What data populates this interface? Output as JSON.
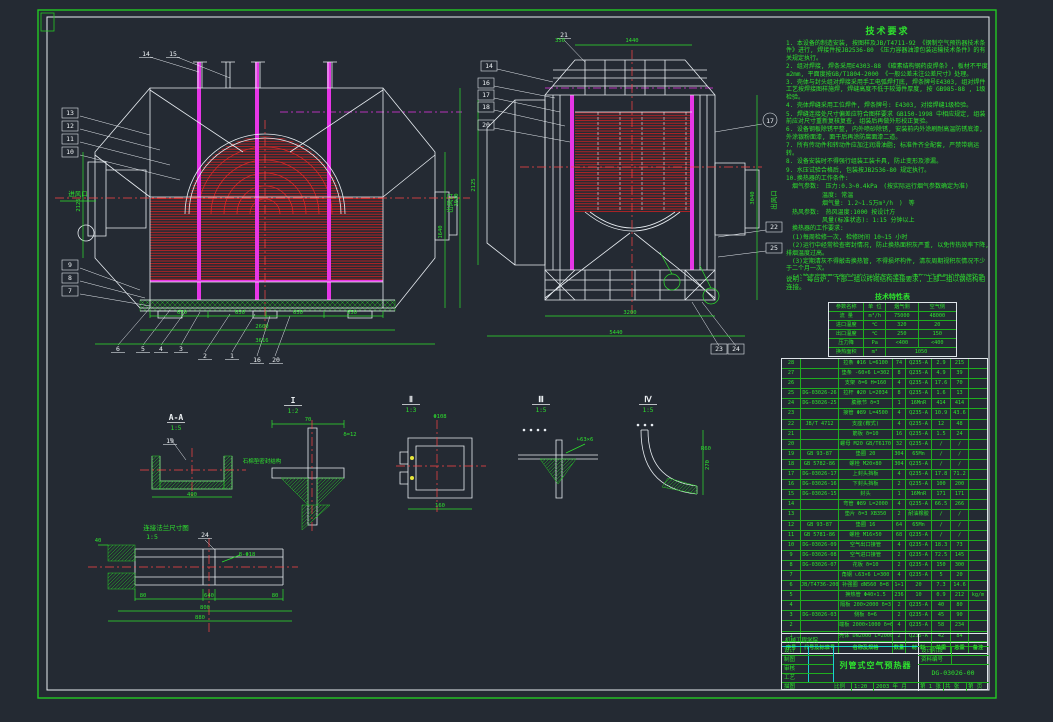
{
  "colors": {
    "green": "#2ee22e",
    "white": "#eef2f5",
    "red": "#d42a2a",
    "centerline_red": "#ff4545",
    "magenta": "#e636e6",
    "cyan": "#19d2d2",
    "yellow": "#e8e83a",
    "background": "#242a33"
  },
  "tech_requirements": {
    "title": "技术要求",
    "items": [
      "1. 本设备的制造安装, 按图样及JB/T4711-92 《钢制空气预热器技术条件》进行, 焊接件按JB2536-80 《压力容器油漆包装运输技术条件》的有关规定执行。",
      "2. 组对焊接, 焊条采用E4303-88 《碳素结构钢药皮焊条》, 板材不平度≤2mm, 平面度按GB/T1804-2000 《一般公差未注公差尺寸》处理。",
      "3. 壳体与封头组对焊接采用手工电弧焊打底, 焊条牌号E4303, 组对焊件工艺按焊接图样施焊, 焊缝高度不低于较薄件厚度, 按 GB985-88 , 1级检验。",
      "4. 壳体焊缝采用工位焊件, 焊条牌号: E4303, 对接焊缝1级检验。",
      "5. 焊缝连接处尺寸偏差应符合图样要求 GB150-1998 中相应规定, 组装前应对尺寸重新复核复查, 组装后再做外形校正复验。",
      "6. 设备钢板除锈平整, 内外喷砂除锈, 安装前内外涂刷耐高温防锈底漆, 外涂银粉面漆, 面干后再涂防腐面漆二道。",
      "7. 所有传动件和转动件应加注润滑油脂; 标准件齐全配套, 严禁带病运转。",
      "8. 设备安装时不得强行组装工装卡具, 防止变形及渗漏。",
      "9. 水压试验合格后, 包装按JB2536-80 规定执行。",
      "10.换热器的工作条件:",
      "　烟气参数:　压力:0.3~0.4kPa　(按实际运行烟气参数确定为准)",
      "　　　　　　温度: 常温",
      "　　　　　　烟气量: 1.2~1.5万m³/h　)　等",
      "　热风参数:　热风温度:1000 按设计方",
      "　　　　　　风量(标准状态): 1:15 分钟以上",
      "　换热器的工作要求:",
      "　(1)每周检修一次, 检修时间 10~15 小时",
      "　(2)运行中经常检查密封情况, 防止换热面积灰严重, 以免传热效率下降, 排烟温度过高。",
      "　(3)定期清灰不得敲击换热管, 不得损坏构件, 清灰周期视积灰情况不少于二个月一次。",
      "　(4)管束定期用压缩空气吹扫以防积灰堵塞, 清灰时注意保护换热管防腐层不受损伤。"
    ]
  },
  "note": "说明: 每台炉, 下部二组以砖砌结构连接要求, 上部二组以钢结构相连接。",
  "char_table": {
    "title": "技术特性表",
    "col_headers": [
      "参数名称",
      "单 位",
      "烟气侧",
      "空气侧"
    ],
    "rows": [
      [
        "流  量",
        "m³/h",
        "75000",
        "48000"
      ],
      [
        "进口温度",
        "℃",
        "320",
        "20"
      ],
      [
        "出口温度",
        "℃",
        "250",
        "150"
      ],
      [
        "压力降",
        "Pa",
        "<400",
        "<400"
      ]
    ],
    "footer": {
      "label": "换热面积",
      "unit": "m²",
      "value": "1050"
    }
  },
  "bom": {
    "headers": [
      "序号",
      "代号及标准号",
      "名称及规格",
      "数量",
      "材 料",
      "单重",
      "总重",
      "备注"
    ],
    "rows": [
      [
        "28",
        "",
        "拉条 Φ16 L=6100",
        "74",
        "Q235-A",
        "2.9",
        "215",
        ""
      ],
      [
        "27",
        "",
        "垫条 -60×6 L=302",
        "8",
        "Q235-A",
        "4.9",
        "39",
        ""
      ],
      [
        "26",
        "",
        "支架 δ=6 H=160",
        "4",
        "Q235-A",
        "17.6",
        "70",
        ""
      ],
      [
        "25",
        "DG-03026-26",
        "拉杆 Φ20 L=2034",
        "8",
        "Q235-A",
        "1.6",
        "13",
        ""
      ],
      [
        "24",
        "DG-03026-25",
        "膨胀节 δ=3",
        "1",
        "16MnR",
        "414",
        "414",
        ""
      ],
      [
        "23",
        "",
        "接管 Φ89 L=4500",
        "4",
        "Q235-A",
        "10.9",
        "43.6",
        ""
      ],
      [
        "22",
        "JB/T 4712",
        "支座(鞍式)",
        "4",
        "Q235-A",
        "12",
        "48",
        ""
      ],
      [
        "21",
        "",
        "筋板 δ=10",
        "16",
        "Q235-A",
        "1.5",
        "24",
        ""
      ],
      [
        "20",
        "",
        "螺母 M20 GB/T6170",
        "32",
        "Q235-A",
        "∕",
        "∕",
        ""
      ],
      [
        "19",
        "GB 93-87",
        "垫圈 20",
        "304",
        "65Mn",
        "∕",
        "∕",
        ""
      ],
      [
        "18",
        "GB 5782-86",
        "螺栓 M20×80",
        "304",
        "Q235-A",
        "∕",
        "∕",
        ""
      ],
      [
        "17",
        "DG-03026-17",
        "上封头挡板",
        "4",
        "Q235-A",
        "17.8",
        "71.2",
        ""
      ],
      [
        "16",
        "DG-03026-16",
        "下封头挡板",
        "2",
        "Q235-A",
        "100",
        "200",
        ""
      ],
      [
        "15",
        "DG-03026-15",
        "封头",
        "1",
        "16MnR",
        "171",
        "171",
        ""
      ],
      [
        "14",
        "",
        "弯管 Φ89 L=2000",
        "4",
        "Q235-A",
        "66.5",
        "266",
        ""
      ],
      [
        "13",
        "",
        "垫片 δ=3 XB350",
        "2",
        "耐油橡胶",
        "∕",
        "∕",
        ""
      ],
      [
        "12",
        "GB 93-87",
        "垫圈 16",
        "64",
        "65Mn",
        "∕",
        "∕",
        ""
      ],
      [
        "11",
        "GB 5781-86",
        "螺栓 M16×50",
        "68",
        "Q235-A",
        "∕",
        "∕",
        ""
      ],
      [
        "10",
        "DG-03026-09",
        "空气出口接管",
        "4",
        "Q235-A",
        "18.3",
        "73",
        ""
      ],
      [
        "9",
        "DG-03026-08",
        "空气进口接管",
        "2",
        "Q235-A",
        "72.5",
        "145",
        ""
      ],
      [
        "8",
        "DG-03026-07",
        "花板 δ=10",
        "2",
        "Q235-A",
        "150",
        "300",
        ""
      ],
      [
        "7",
        "",
        "角钢 ∟63×6 L=300",
        "4",
        "Q235-A",
        "5",
        "20",
        ""
      ],
      [
        "6",
        "JB/T4736-2002",
        "补强圈 dN560 δ=8",
        "1+1",
        "20",
        "7.3",
        "14.6",
        ""
      ],
      [
        "5",
        "",
        "换热管 Φ40×1.5",
        "236",
        "10",
        "0.9",
        "212",
        "kg/m"
      ],
      [
        "4",
        "",
        "隔板 200×2000 δ=3",
        "2",
        "Q235-A",
        "40",
        "80",
        ""
      ],
      [
        "3",
        "DG-03026-03",
        "侧板 δ=6",
        "2",
        "Q235-A",
        "45",
        "90",
        ""
      ],
      [
        "2",
        "",
        "端板 2000×1000 δ=6",
        "4",
        "Q235-A",
        "58",
        "234",
        ""
      ],
      [
        "1",
        "",
        "壳体 DN2000 L=2000",
        "2",
        "Q235-A",
        "42",
        "84",
        ""
      ]
    ]
  },
  "title_block": {
    "company": "机械工程学院",
    "roles": [
      "设计",
      "制图",
      "审核",
      "工艺"
    ],
    "title": "列管式空气预热器",
    "stage_label": "设计阶段",
    "doc_label": "资料编号",
    "drawing_no": "DG-03026-00",
    "bottom": {
      "left_label": "描图",
      "scale_label": "比例",
      "scale": "1:20",
      "date": "2003 年 月",
      "sheet1": "第 1 张",
      "sheet2": "共 张",
      "sheet3": "第 页"
    }
  },
  "annotations": {
    "balloons": [
      {
        "n": "14",
        "x": 146,
        "y": 55,
        "s": "p"
      },
      {
        "n": "15",
        "x": 173,
        "y": 55,
        "s": "p"
      },
      {
        "n": "13",
        "x": 70,
        "y": 114,
        "s": "b"
      },
      {
        "n": "12",
        "x": 70,
        "y": 127,
        "s": "b"
      },
      {
        "n": "11",
        "x": 70,
        "y": 140,
        "s": "b"
      },
      {
        "n": "10",
        "x": 70,
        "y": 153,
        "s": "b"
      },
      {
        "n": "9",
        "x": 70,
        "y": 266,
        "s": "b"
      },
      {
        "n": "8",
        "x": 70,
        "y": 279,
        "s": "b"
      },
      {
        "n": "7",
        "x": 70,
        "y": 292,
        "s": "b"
      },
      {
        "n": "6",
        "x": 118,
        "y": 350,
        "s": "p"
      },
      {
        "n": "5",
        "x": 143,
        "y": 350,
        "s": "p"
      },
      {
        "n": "4",
        "x": 161,
        "y": 350,
        "s": "p"
      },
      {
        "n": "3",
        "x": 181,
        "y": 350,
        "s": "p"
      },
      {
        "n": "2",
        "x": 205,
        "y": 357,
        "s": "p"
      },
      {
        "n": "1",
        "x": 232,
        "y": 357,
        "s": "p"
      },
      {
        "n": "16",
        "x": 257,
        "y": 361,
        "s": "p"
      },
      {
        "n": "20",
        "x": 276,
        "y": 361,
        "s": "p"
      },
      {
        "n": "19",
        "x": 170,
        "y": 442,
        "s": "p"
      },
      {
        "n": "24",
        "x": 205,
        "y": 536,
        "s": "p"
      },
      {
        "n": "21",
        "x": 564,
        "y": 36,
        "s": "p"
      },
      {
        "n": "14",
        "x": 489,
        "y": 67,
        "s": "b"
      },
      {
        "n": "16",
        "x": 486,
        "y": 84,
        "s": "b"
      },
      {
        "n": "17",
        "x": 486,
        "y": 96,
        "s": "b"
      },
      {
        "n": "18",
        "x": 486,
        "y": 108,
        "s": "b"
      },
      {
        "n": "20",
        "x": 486,
        "y": 126,
        "s": "b"
      },
      {
        "n": "17",
        "x": 770,
        "y": 122,
        "s": "c"
      },
      {
        "n": "22",
        "x": 774,
        "y": 228,
        "s": "b"
      },
      {
        "n": "25",
        "x": 774,
        "y": 249,
        "s": "b"
      },
      {
        "n": "23",
        "x": 719,
        "y": 350,
        "s": "b"
      },
      {
        "n": "24",
        "x": 736,
        "y": 350,
        "s": "b"
      }
    ],
    "dims": [
      {
        "t": "650",
        "x": 182,
        "y": 314
      },
      {
        "t": "650",
        "x": 240,
        "y": 314
      },
      {
        "t": "650",
        "x": 298,
        "y": 314
      },
      {
        "t": "650",
        "x": 352,
        "y": 314
      },
      {
        "t": "2600",
        "x": 262,
        "y": 328
      },
      {
        "t": "3616",
        "x": 262,
        "y": 342
      },
      {
        "t": "2125",
        "x": 80,
        "y": 205,
        "r": 1
      },
      {
        "t": "3040",
        "x": 458,
        "y": 200,
        "r": 1
      },
      {
        "t": "1640",
        "x": 442,
        "y": 232,
        "r": 1
      },
      {
        "t": "350",
        "x": 560,
        "y": 42
      },
      {
        "t": "1440",
        "x": 632,
        "y": 42
      },
      {
        "t": "3200",
        "x": 630,
        "y": 314
      },
      {
        "t": "5440",
        "x": 616,
        "y": 334
      },
      {
        "t": "3040",
        "x": 754,
        "y": 198,
        "r": 1
      },
      {
        "t": "2125",
        "x": 475,
        "y": 185,
        "r": 1
      },
      {
        "t": "40",
        "x": 98,
        "y": 542
      },
      {
        "t": "80",
        "x": 143,
        "y": 597
      },
      {
        "t": "640",
        "x": 209,
        "y": 597
      },
      {
        "t": "80",
        "x": 275,
        "y": 597
      },
      {
        "t": "800",
        "x": 205,
        "y": 609
      },
      {
        "t": "880",
        "x": 200,
        "y": 619
      },
      {
        "t": "8-Φ18",
        "x": 247,
        "y": 556
      },
      {
        "t": "70",
        "x": 308,
        "y": 421
      },
      {
        "t": "δ=12",
        "x": 350,
        "y": 436
      },
      {
        "t": "Φ108",
        "x": 440,
        "y": 418
      },
      {
        "t": "160",
        "x": 440,
        "y": 507
      },
      {
        "t": "∟63×6",
        "x": 585,
        "y": 441
      },
      {
        "t": "R60",
        "x": 706,
        "y": 450
      },
      {
        "t": "270",
        "x": 709,
        "y": 465,
        "r": 1
      },
      {
        "t": "400",
        "x": 192,
        "y": 496
      }
    ],
    "labels": [
      {
        "t": "进风口",
        "x": 78,
        "y": 196
      },
      {
        "t": "出风口",
        "x": 452,
        "y": 203,
        "r": 1
      },
      {
        "t": "出风口",
        "x": 776,
        "y": 200,
        "r": 1
      },
      {
        "t": "石棉垫密封结构",
        "x": 262,
        "y": 463,
        "sz": 5.5
      },
      {
        "t": "连接法兰尺寸图",
        "x": 166,
        "y": 530
      },
      {
        "t": "1:5",
        "x": 152,
        "y": 539
      }
    ],
    "section_marks": [
      {
        "l": "A-A",
        "s": "1:5",
        "x": 176,
        "y": 420
      },
      {
        "l": "I",
        "s": "1:2",
        "x": 293,
        "y": 403
      },
      {
        "l": "Ⅱ",
        "s": "1:3",
        "x": 411,
        "y": 402
      },
      {
        "l": "Ⅲ",
        "s": "1:5",
        "x": 541,
        "y": 402
      },
      {
        "l": "Ⅳ",
        "s": "1:5",
        "x": 648,
        "y": 402
      }
    ]
  }
}
